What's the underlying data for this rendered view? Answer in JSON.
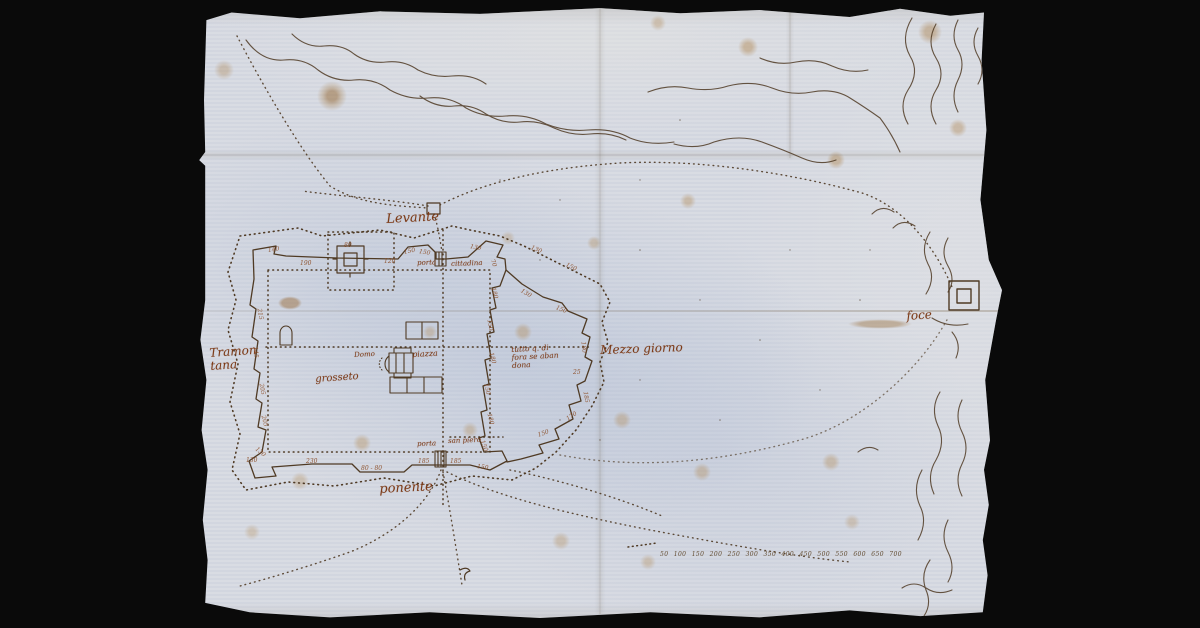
{
  "map": {
    "colors": {
      "background": "#0a0a0a",
      "paper": "#d7dae2",
      "ink": "#4f3a24",
      "label_ink": "#7c3a17"
    },
    "labels": [
      {
        "id": "levante",
        "text": "Levante",
        "x": 386,
        "y": 213,
        "size": 13,
        "rot": -3
      },
      {
        "id": "tramontana",
        "text": "Tramon\ntana",
        "x": 209,
        "y": 347,
        "size": 12,
        "rot": -4
      },
      {
        "id": "mezzo-giorno",
        "text": "Mezzo giorno",
        "x": 600,
        "y": 344,
        "size": 12,
        "rot": -2
      },
      {
        "id": "ponente",
        "text": "ponente",
        "x": 379,
        "y": 483,
        "size": 13,
        "rot": -3
      },
      {
        "id": "foce",
        "text": "foce",
        "x": 906,
        "y": 310,
        "size": 12,
        "rot": -4
      },
      {
        "id": "grosseto",
        "text": "grosseto",
        "x": 315,
        "y": 375,
        "size": 10,
        "rot": -4
      },
      {
        "id": "domo",
        "text": "Domo",
        "x": 354,
        "y": 352,
        "size": 7,
        "rot": -3
      },
      {
        "id": "piazza",
        "text": "piazza",
        "x": 412,
        "y": 351,
        "size": 8,
        "rot": -3
      },
      {
        "id": "porta-cittadina-word1",
        "text": "porta",
        "x": 417,
        "y": 260,
        "size": 7,
        "rot": -2
      },
      {
        "id": "porta-cittadina-word2",
        "text": "cittadina",
        "x": 451,
        "y": 261,
        "size": 7,
        "rot": -2
      },
      {
        "id": "porta-san-piero-word1",
        "text": "porta",
        "x": 417,
        "y": 441,
        "size": 7,
        "rot": -2
      },
      {
        "id": "porta-san-piero-word2",
        "text": "san piero",
        "x": 448,
        "y": 438,
        "size": 7,
        "rot": -2
      },
      {
        "id": "nota-abbandono",
        "text": "tutto q. di\nfora se aban\ndona",
        "x": 511,
        "y": 346,
        "size": 7.5,
        "rot": -3
      }
    ],
    "measurements": [
      {
        "v": "140",
        "x": 268,
        "y": 247,
        "rot": -8
      },
      {
        "v": "190",
        "x": 300,
        "y": 260,
        "rot": 0
      },
      {
        "v": "80",
        "x": 344,
        "y": 242,
        "rot": 0
      },
      {
        "v": "120",
        "x": 384,
        "y": 258,
        "rot": 0
      },
      {
        "v": "150",
        "x": 404,
        "y": 249,
        "rot": -12
      },
      {
        "v": "150",
        "x": 419,
        "y": 248,
        "rot": 10
      },
      {
        "v": "130",
        "x": 470,
        "y": 243,
        "rot": 12
      },
      {
        "v": "70",
        "x": 492,
        "y": 256,
        "rot": 70
      },
      {
        "v": "180",
        "x": 493,
        "y": 284,
        "rot": 76
      },
      {
        "v": "150",
        "x": 489,
        "y": 316,
        "rot": 80
      },
      {
        "v": "180",
        "x": 491,
        "y": 349,
        "rot": 76
      },
      {
        "v": "150",
        "x": 486,
        "y": 380,
        "rot": 80
      },
      {
        "v": "180",
        "x": 489,
        "y": 410,
        "rot": 76
      },
      {
        "v": "150",
        "x": 482,
        "y": 437,
        "rot": 70
      },
      {
        "v": "215",
        "x": 259,
        "y": 305,
        "rot": 80
      },
      {
        "v": "145",
        "x": 255,
        "y": 343,
        "rot": 84
      },
      {
        "v": "205",
        "x": 261,
        "y": 380,
        "rot": 80
      },
      {
        "v": "205",
        "x": 263,
        "y": 412,
        "rot": 76
      },
      {
        "v": "130",
        "x": 256,
        "y": 445,
        "rot": 40
      },
      {
        "v": "130",
        "x": 246,
        "y": 457,
        "rot": 0
      },
      {
        "v": "230",
        "x": 306,
        "y": 458,
        "rot": 0
      },
      {
        "v": "80 - 80",
        "x": 361,
        "y": 465,
        "rot": 0
      },
      {
        "v": "185",
        "x": 418,
        "y": 458,
        "rot": 0
      },
      {
        "v": "185",
        "x": 450,
        "y": 458,
        "rot": 0
      },
      {
        "v": "150",
        "x": 477,
        "y": 463,
        "rot": 8
      },
      {
        "v": "130",
        "x": 531,
        "y": 244,
        "rot": 22
      },
      {
        "v": "150",
        "x": 566,
        "y": 261,
        "rot": 26
      },
      {
        "v": "130",
        "x": 521,
        "y": 287,
        "rot": 30
      },
      {
        "v": "150",
        "x": 556,
        "y": 304,
        "rot": 22
      },
      {
        "v": "180",
        "x": 583,
        "y": 338,
        "rot": 84
      },
      {
        "v": "25",
        "x": 573,
        "y": 369,
        "rot": 0
      },
      {
        "v": "185",
        "x": 585,
        "y": 388,
        "rot": 80
      },
      {
        "v": "170",
        "x": 567,
        "y": 416,
        "rot": -34
      },
      {
        "v": "150",
        "x": 538,
        "y": 432,
        "rot": -20
      }
    ],
    "scale_bar": {
      "values": "50 100 150 200 250 300 350 400 450 500 550 600 650 700"
    }
  }
}
